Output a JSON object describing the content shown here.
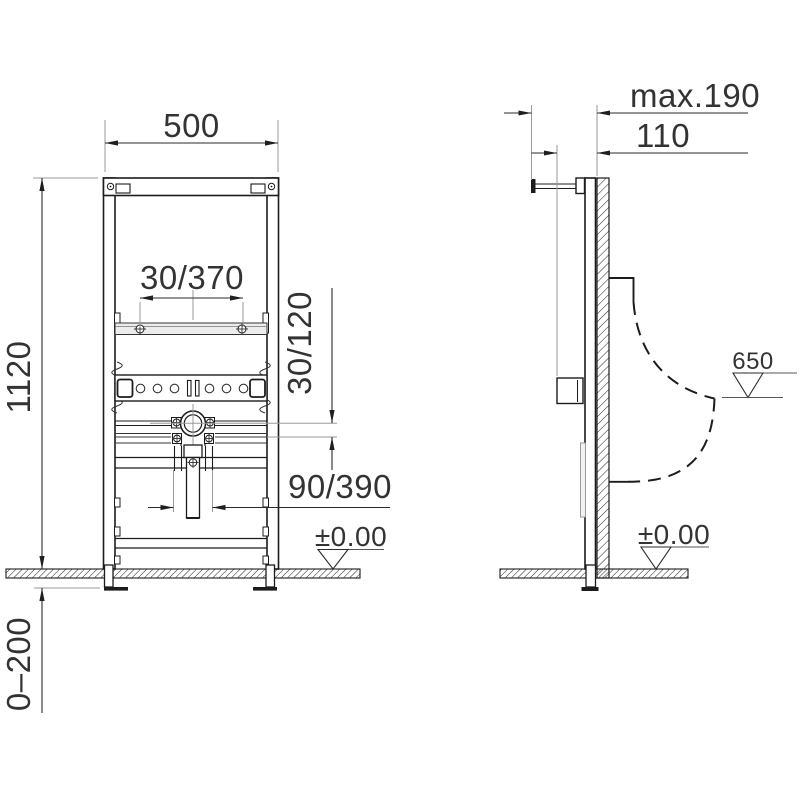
{
  "drawing": {
    "type": "installation-diagram",
    "views": [
      "front",
      "side"
    ],
    "labels": {
      "front": {
        "width": "500",
        "height": "1120",
        "fixing_distance": "30/370",
        "inlet_offset": "30/120",
        "drain_offset": "90/390",
        "floor_level": "±0.00",
        "foot_adjustment": "0–200"
      },
      "side": {
        "max_depth": "max.190",
        "inlet_depth": "110",
        "rim_height": "650",
        "floor_level": "±0.00"
      }
    },
    "colors": {
      "line": "#1c1c1c",
      "aux_line": "#9a9a9a",
      "text": "#333333",
      "background": "#ffffff"
    }
  }
}
